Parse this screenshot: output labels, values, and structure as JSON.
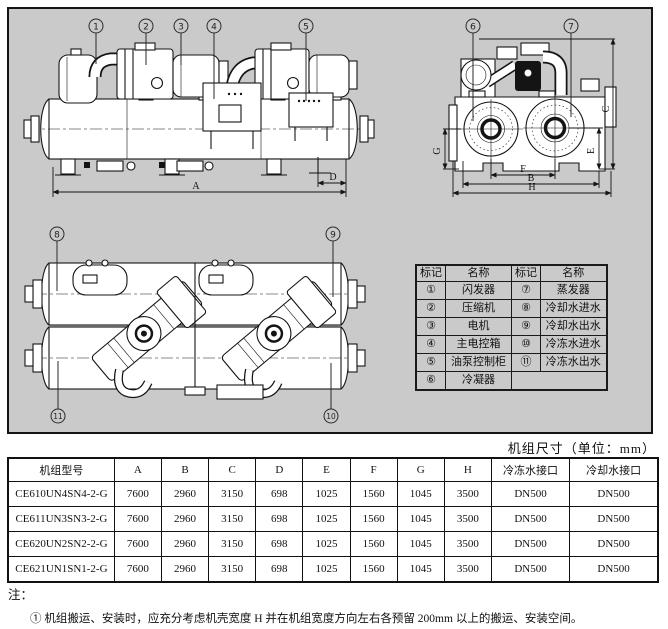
{
  "panel": {
    "callouts": {
      "side": [
        "1",
        "2",
        "3",
        "4",
        "5"
      ],
      "end": [
        "6",
        "7"
      ],
      "plan_top": [
        "8",
        "9"
      ],
      "plan_bottom": [
        "11",
        "10"
      ]
    },
    "dims": {
      "A": "A",
      "B": "B",
      "C": "C",
      "D": "D",
      "E": "E",
      "F": "F",
      "G": "G",
      "H": "H"
    }
  },
  "legend": {
    "col_headers": [
      "标记",
      "名称",
      "标记",
      "名称"
    ],
    "rows": [
      [
        "①",
        "闪发器",
        "⑦",
        "蒸发器"
      ],
      [
        "②",
        "压缩机",
        "⑧",
        "冷却水进水"
      ],
      [
        "③",
        "电机",
        "⑨",
        "冷却水出水"
      ],
      [
        "④",
        "主电控箱",
        "⑩",
        "冷冻水进水"
      ],
      [
        "⑤",
        "油泵控制柜",
        "⑪",
        "冷冻水出水"
      ],
      [
        "⑥",
        "冷凝器",
        null,
        null
      ]
    ]
  },
  "size_table": {
    "title": "机组尺寸（单位：mm）",
    "headers": [
      "机组型号",
      "A",
      "B",
      "C",
      "D",
      "E",
      "F",
      "G",
      "H",
      "冷冻水接口",
      "冷却水接口"
    ],
    "rows": [
      [
        "CE610UN4SN4-2-G",
        "7600",
        "2960",
        "3150",
        "698",
        "1025",
        "1560",
        "1045",
        "3500",
        "DN500",
        "DN500"
      ],
      [
        "CE611UN3SN3-2-G",
        "7600",
        "2960",
        "3150",
        "698",
        "1025",
        "1560",
        "1045",
        "3500",
        "DN500",
        "DN500"
      ],
      [
        "CE620UN2SN2-2-G",
        "7600",
        "2960",
        "3150",
        "698",
        "1025",
        "1560",
        "1045",
        "3500",
        "DN500",
        "DN500"
      ],
      [
        "CE621UN1SN1-2-G",
        "7600",
        "2960",
        "3150",
        "698",
        "1025",
        "1560",
        "1045",
        "3500",
        "DN500",
        "DN500"
      ]
    ]
  },
  "notes": {
    "label": "注：",
    "items": [
      "① 机组搬运、安装时，应充分考虑机壳宽度 H 并在机组宽度方向左右各预留 200mm 以上的搬运、安装空间。"
    ]
  },
  "colors": {
    "panel_bg": "#cacaca",
    "line": "#141414",
    "page_bg": "#ffffff"
  }
}
